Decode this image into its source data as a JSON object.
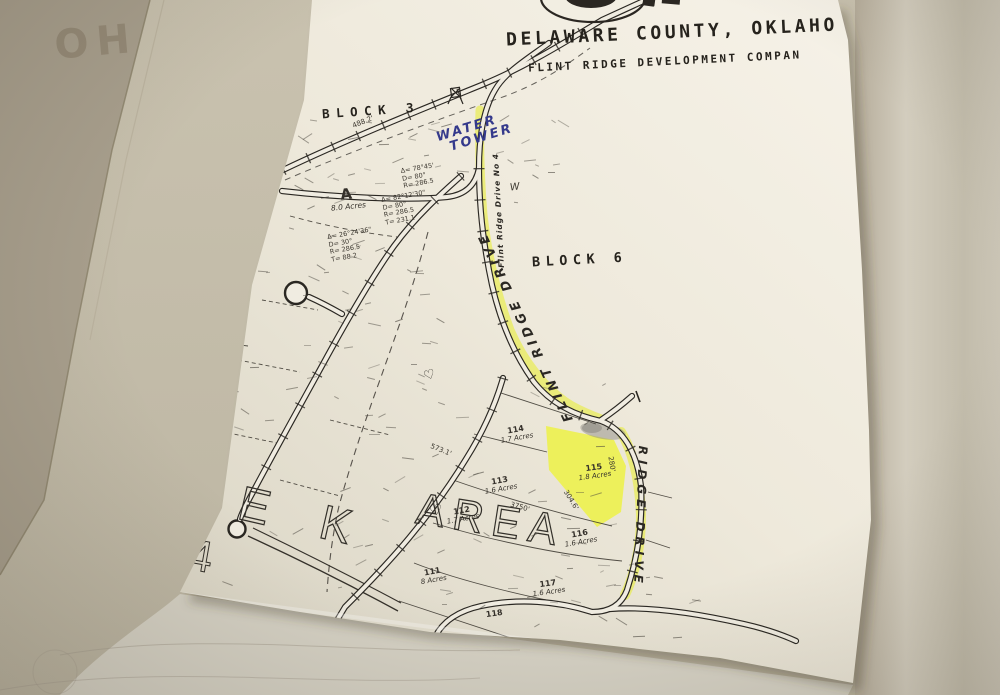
{
  "background": {
    "bleed_text": "HO"
  },
  "header": {
    "line1": "DELAWARE COUNTY, OKLAHO",
    "line2": "FLINT RIDGE DEVELOPMENT COMPAN"
  },
  "map": {
    "blocks": [
      {
        "label": "BLOCK 3"
      },
      {
        "label": "BLOCK 6"
      }
    ],
    "handwriting": {
      "water_tower_line1": "WATER",
      "water_tower_line2": "TOWER",
      "road_small": "Flint Ridge Drive No 4",
      "road_mid": "FLINT RIDGE DRIVE",
      "road_lower": "RIDGE DRIVE",
      "pen_mark": "W",
      "heart": "♡"
    },
    "creek_text": {
      "left": "E K",
      "right": "AREA",
      "numeral": "4"
    },
    "parcels": [
      {
        "id": "A",
        "acres": "8.0 Acres"
      },
      {
        "id": "115",
        "acres": "1.8 Acres"
      },
      {
        "id": "114",
        "acres": "1.7 Acres"
      },
      {
        "id": "113",
        "acres": "1.6 Acres"
      },
      {
        "id": "112",
        "acres": "1.7 Acres"
      },
      {
        "id": "116",
        "acres": "1.6 Acres"
      },
      {
        "id": "111",
        "acres": "8 Acres"
      },
      {
        "id": "117",
        "acres": "1.6 Acres"
      },
      {
        "id": "118",
        "acres": ""
      }
    ],
    "curve_notes": [
      {
        "l1": "Δ= 78°45'",
        "l2": "D= 80°",
        "l3": "R= 286.5",
        "l4": ""
      },
      {
        "l1": "Δ= 82°12'30\"",
        "l2": "D= 80°",
        "l3": "R= 286.5",
        "l4": "T= 231.1"
      },
      {
        "l1": "Δ= 26°24'36\"",
        "l2": "D= 30°",
        "l3": "R= 286.5",
        "l4": "T= 88.2"
      }
    ],
    "dimensions": [
      {
        "text": "488.2'"
      },
      {
        "text": "304.6'"
      },
      {
        "text": "280'"
      },
      {
        "text": "3750'"
      },
      {
        "text": "573.1'"
      }
    ]
  },
  "colors": {
    "highlight": "#e9ee3f",
    "ink_blue": "#34398b",
    "line": "#2b2824",
    "paper": "#f2eee3"
  }
}
